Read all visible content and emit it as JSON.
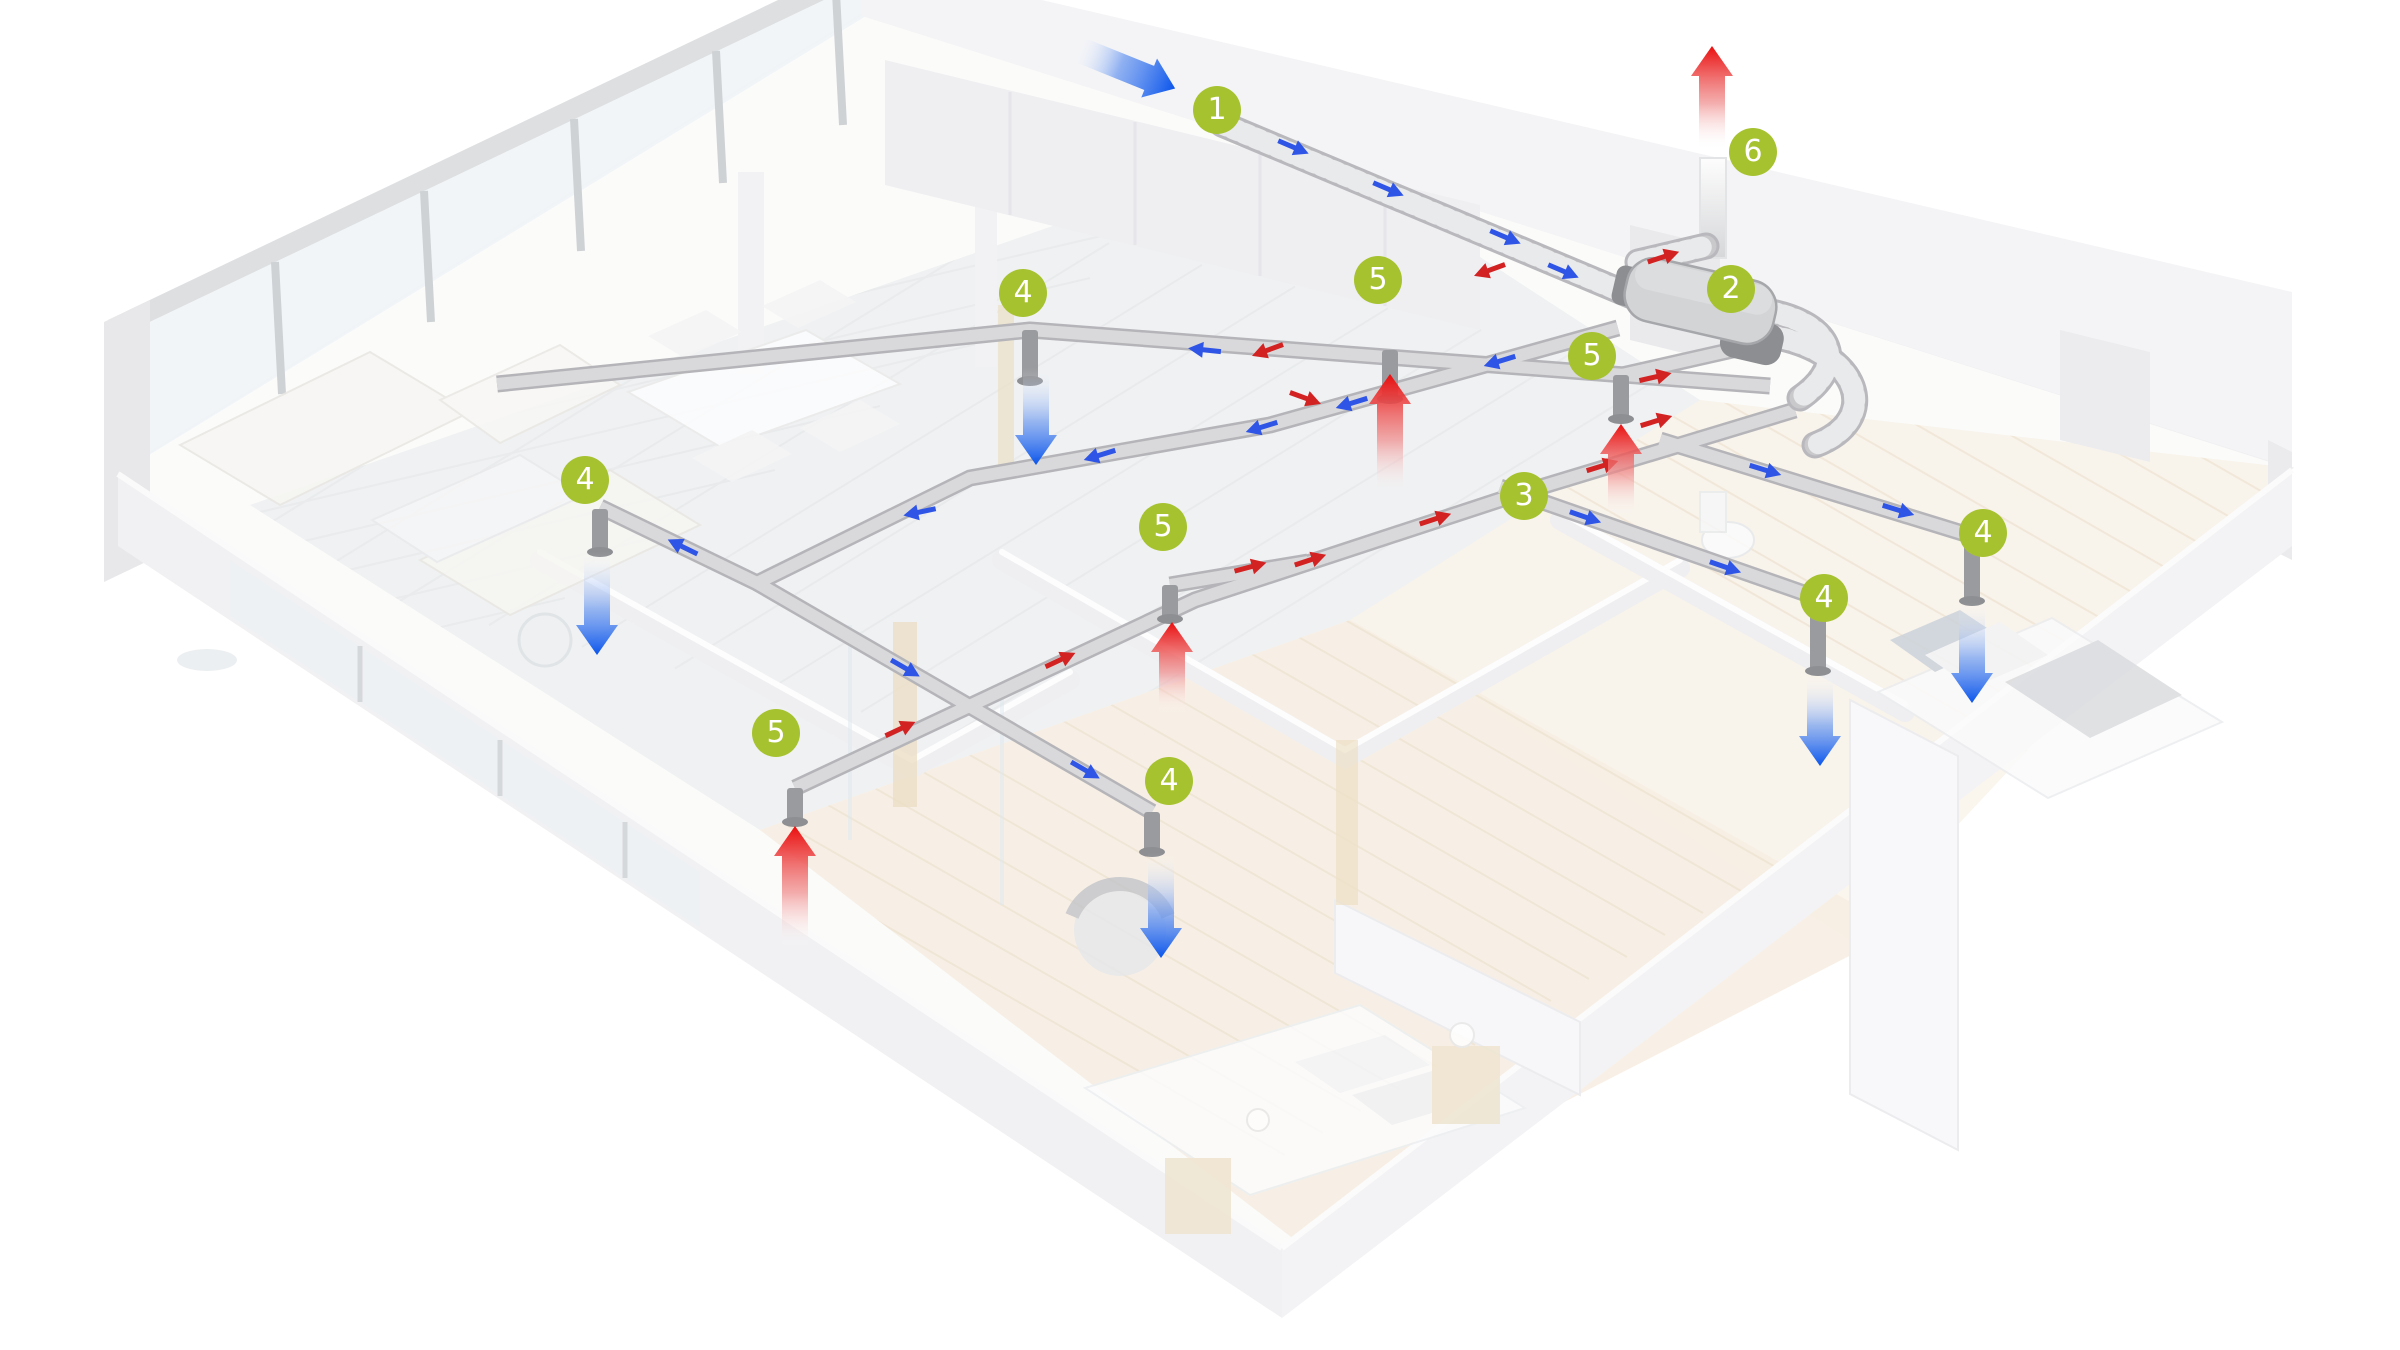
{
  "meta": {
    "description": "Isometric cutaway apartment showing a heat-recovery ventilation system with numbered component hotspots and airflow arrows",
    "canvas_width": 2400,
    "canvas_height": 1350
  },
  "colors": {
    "badge_fill": "#a6c22f",
    "badge_text": "#ffffff",
    "supply_small": "#2f55e6",
    "extract_small": "#d32222",
    "supply_big": "#0b55ec",
    "extract_big": "#ea0e0e",
    "duct": "#d9d9db",
    "duct_edge": "#b5b5b9",
    "insulated_duct": "#c8c8cb",
    "unit_body": "#d3d4d6"
  },
  "badges": [
    {
      "label": "1",
      "x": 1217,
      "y": 110,
      "meaning": "outdoor-air-intake-duct"
    },
    {
      "label": "2",
      "x": 1731,
      "y": 289,
      "meaning": "heat-recovery-unit"
    },
    {
      "label": "3",
      "x": 1524,
      "y": 496,
      "meaning": "flat-duct-distribution"
    },
    {
      "label": "4",
      "x": 1023,
      "y": 293,
      "meaning": "supply-valve"
    },
    {
      "label": "4",
      "x": 585,
      "y": 480,
      "meaning": "supply-valve"
    },
    {
      "label": "4",
      "x": 1983,
      "y": 533,
      "meaning": "supply-valve"
    },
    {
      "label": "4",
      "x": 1824,
      "y": 598,
      "meaning": "supply-valve"
    },
    {
      "label": "4",
      "x": 1169,
      "y": 781,
      "meaning": "supply-valve"
    },
    {
      "label": "5",
      "x": 1378,
      "y": 280,
      "meaning": "extract-valve"
    },
    {
      "label": "5",
      "x": 1592,
      "y": 356,
      "meaning": "extract-valve"
    },
    {
      "label": "5",
      "x": 1163,
      "y": 527,
      "meaning": "extract-valve"
    },
    {
      "label": "5",
      "x": 776,
      "y": 733,
      "meaning": "extract-valve"
    },
    {
      "label": "6",
      "x": 1753,
      "y": 152,
      "meaning": "roof-exhaust"
    }
  ],
  "large_arrows": [
    {
      "id": "outdoor-intake",
      "color": "blue",
      "kind": "angled",
      "x": 1075,
      "y": 48,
      "angle": 22,
      "length": 108
    },
    {
      "id": "roof-exhaust",
      "color": "red",
      "kind": "up",
      "x": 1712,
      "y1": 150,
      "y2": 46
    },
    {
      "id": "supply-kitchen",
      "color": "blue",
      "kind": "down",
      "x": 1036,
      "y1": 368,
      "y2": 465
    },
    {
      "id": "supply-living",
      "color": "blue",
      "kind": "down",
      "x": 597,
      "y1": 552,
      "y2": 655
    },
    {
      "id": "supply-bedroom-right",
      "color": "blue",
      "kind": "down",
      "x": 1972,
      "y1": 603,
      "y2": 703
    },
    {
      "id": "supply-bedroom-middle",
      "color": "blue",
      "kind": "down",
      "x": 1820,
      "y1": 676,
      "y2": 766
    },
    {
      "id": "supply-hall-bedroom",
      "color": "blue",
      "kind": "down",
      "x": 1161,
      "y1": 853,
      "y2": 958
    },
    {
      "id": "extract-kitchen",
      "color": "red",
      "kind": "up",
      "x": 1390,
      "y1": 495,
      "y2": 374
    },
    {
      "id": "extract-bathroom-right",
      "color": "red",
      "kind": "up",
      "x": 1621,
      "y1": 515,
      "y2": 424
    },
    {
      "id": "extract-living",
      "color": "red",
      "kind": "up",
      "x": 1172,
      "y1": 714,
      "y2": 622
    },
    {
      "id": "extract-bathroom-left",
      "color": "red",
      "kind": "up",
      "x": 795,
      "y1": 948,
      "y2": 826
    }
  ],
  "small_arrows": [
    {
      "color": "blue",
      "x": 1293,
      "y": 147,
      "angle": 23
    },
    {
      "color": "blue",
      "x": 1388,
      "y": 189,
      "angle": 23
    },
    {
      "color": "blue",
      "x": 1505,
      "y": 237,
      "angle": 23
    },
    {
      "color": "blue",
      "x": 1563,
      "y": 271,
      "angle": 23
    },
    {
      "color": "blue",
      "x": 1500,
      "y": 361,
      "angle": 163
    },
    {
      "color": "blue",
      "x": 1352,
      "y": 403,
      "angle": 163
    },
    {
      "color": "blue",
      "x": 1262,
      "y": 427,
      "angle": 163
    },
    {
      "color": "blue",
      "x": 1100,
      "y": 455,
      "angle": 163
    },
    {
      "color": "blue",
      "x": 920,
      "y": 512,
      "angle": 168
    },
    {
      "color": "blue",
      "x": 683,
      "y": 547,
      "angle": 206
    },
    {
      "color": "blue",
      "x": 905,
      "y": 668,
      "angle": 30
    },
    {
      "color": "blue",
      "x": 1085,
      "y": 770,
      "angle": 30
    },
    {
      "color": "blue",
      "x": 1585,
      "y": 517,
      "angle": 19
    },
    {
      "color": "blue",
      "x": 1725,
      "y": 567,
      "angle": 19
    },
    {
      "color": "blue",
      "x": 1765,
      "y": 470,
      "angle": 17
    },
    {
      "color": "blue",
      "x": 1898,
      "y": 510,
      "angle": 17
    },
    {
      "color": "blue",
      "x": 1205,
      "y": 350,
      "angle": 186
    },
    {
      "color": "red",
      "x": 900,
      "y": 729,
      "angle": 335
    },
    {
      "color": "red",
      "x": 1060,
      "y": 660,
      "angle": 335
    },
    {
      "color": "red",
      "x": 1250,
      "y": 567,
      "angle": 345
    },
    {
      "color": "red",
      "x": 1310,
      "y": 560,
      "angle": 342
    },
    {
      "color": "red",
      "x": 1435,
      "y": 519,
      "angle": 342
    },
    {
      "color": "red",
      "x": 1602,
      "y": 466,
      "angle": 343
    },
    {
      "color": "red",
      "x": 1656,
      "y": 421,
      "angle": 343
    },
    {
      "color": "red",
      "x": 1655,
      "y": 377,
      "angle": 347
    },
    {
      "color": "red",
      "x": 1663,
      "y": 257,
      "angle": 342
    },
    {
      "color": "red",
      "x": 1268,
      "y": 350,
      "angle": 160
    },
    {
      "color": "red",
      "x": 1490,
      "y": 270,
      "angle": 160
    },
    {
      "color": "red",
      "x": 1305,
      "y": 398,
      "angle": 20
    }
  ]
}
